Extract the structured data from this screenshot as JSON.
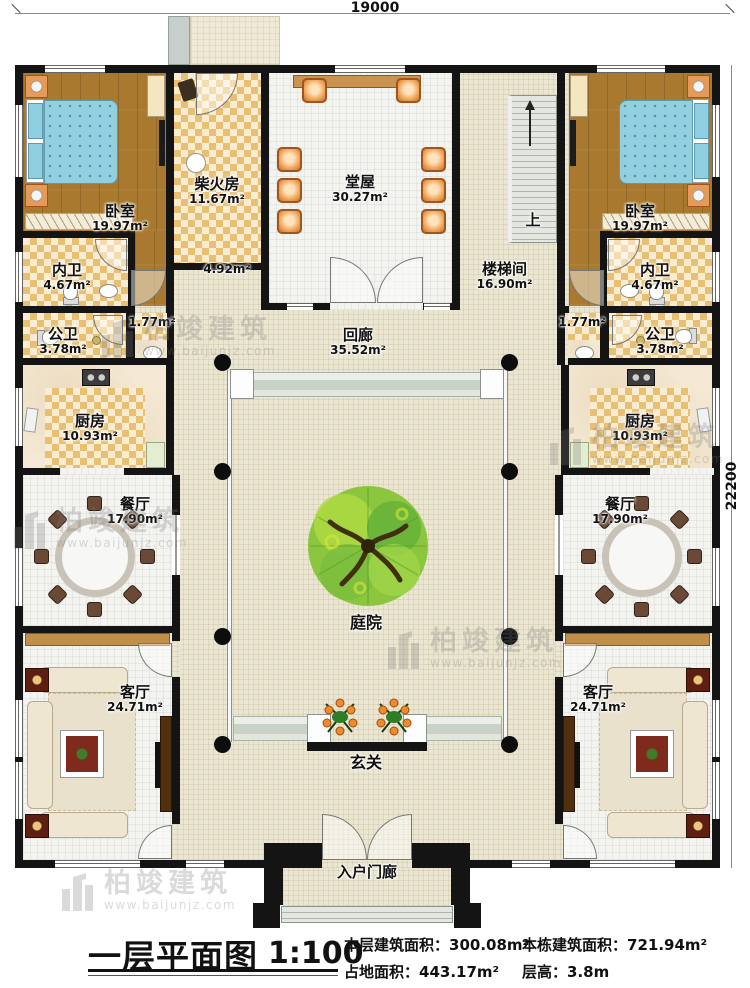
{
  "dimensions": {
    "top": "19000",
    "right": "22200"
  },
  "watermark": {
    "brand": "柏竣建筑",
    "url": "www.baijunjz.com"
  },
  "rooms": {
    "bedroom_left": {
      "name": "卧室",
      "area": "19.97m²"
    },
    "inner_bath_left": {
      "name": "内卫",
      "area": "4.67m²"
    },
    "public_bath_left": {
      "name": "公卫",
      "area": "3.78m²"
    },
    "wash_left": {
      "area": "1.77m²"
    },
    "kitchen_left": {
      "name": "厨房",
      "area": "10.93m²"
    },
    "dining_left": {
      "name": "餐厅",
      "area": "17.90m²"
    },
    "living_left": {
      "name": "客厅",
      "area": "24.71m²"
    },
    "firewood": {
      "name": "柴火房",
      "area": "11.67m²"
    },
    "hall": {
      "name": "堂屋",
      "area": "30.27m²"
    },
    "passage": {
      "area": "4.92m²"
    },
    "stairwell": {
      "name": "楼梯间",
      "area": "16.90m²",
      "up": "上"
    },
    "corridor": {
      "name": "回廊",
      "area": "35.52m²"
    },
    "courtyard": {
      "name": "庭院"
    },
    "foyer": {
      "name": "玄关"
    },
    "porch": {
      "name": "入户门廊"
    },
    "bedroom_right": {
      "name": "卧室",
      "area": "19.97m²"
    },
    "inner_bath_right": {
      "name": "内卫",
      "area": "4.67m²"
    },
    "public_bath_right": {
      "name": "公卫",
      "area": "3.78m²"
    },
    "wash_right": {
      "area": "1.77m²"
    },
    "kitchen_right": {
      "name": "厨房",
      "area": "10.93m²"
    },
    "dining_right": {
      "name": "餐厅",
      "area": "17.90m²"
    },
    "living_right": {
      "name": "客厅",
      "area": "24.71m²"
    }
  },
  "legend": {
    "title": "一层平面图",
    "scale": "1:100",
    "stats": [
      {
        "label": "本层建筑面积：",
        "value": "300.08m²"
      },
      {
        "label": "本栋建筑面积：",
        "value": "721.94m²"
      },
      {
        "label": "占地面积：",
        "value": "443.17m²"
      },
      {
        "label": "层高：",
        "value": "3.8m"
      }
    ]
  }
}
